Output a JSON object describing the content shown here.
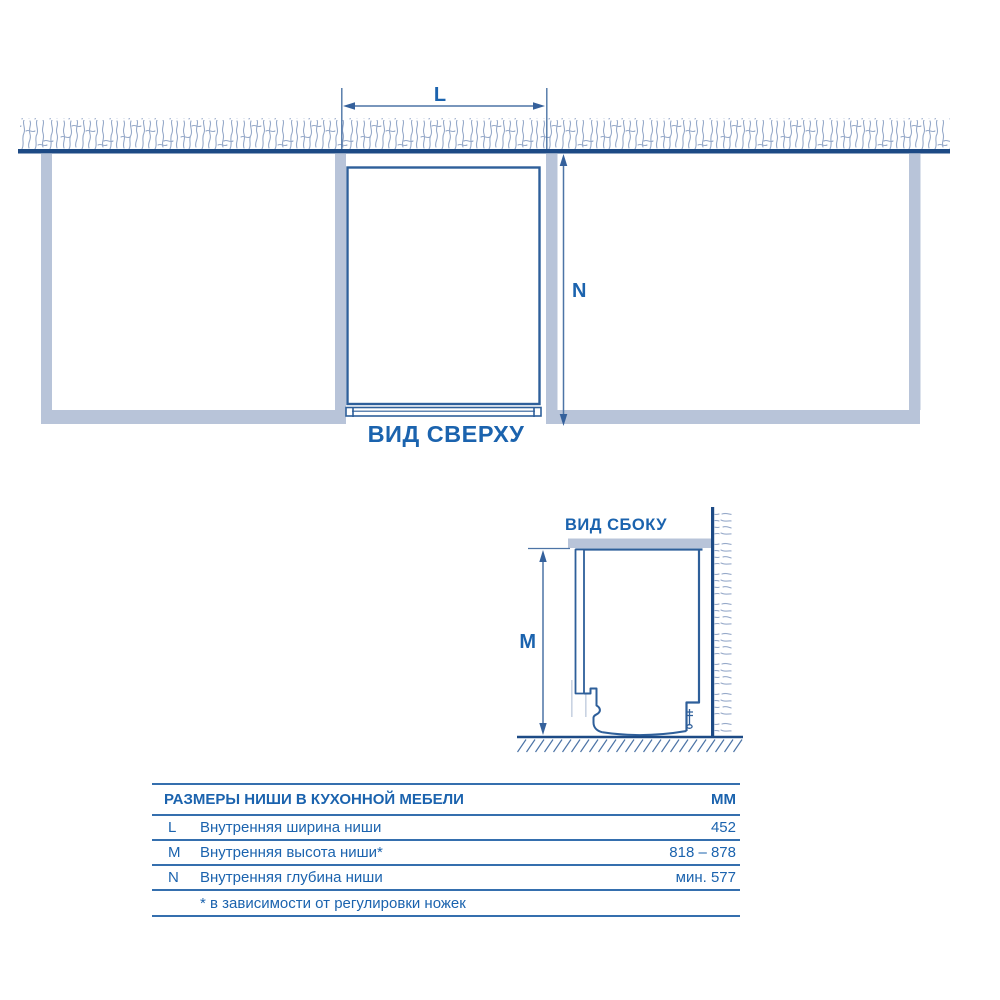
{
  "top_view": {
    "title": "ВИД СВЕРХУ",
    "width_dim_label": "L",
    "depth_dim_label": "N"
  },
  "side_view": {
    "title": "ВИД СБОКУ",
    "height_dim_label": "M"
  },
  "table": {
    "title": "РАЗМЕРЫ НИШИ В КУХОННОЙ МЕБЕЛИ",
    "unit_header": "ММ",
    "rows": [
      {
        "key": "L",
        "description": "Внутренняя ширина ниши",
        "value": "452"
      },
      {
        "key": "M",
        "description": "Внутренняя высота ниши*",
        "value": "818 – 878"
      },
      {
        "key": "N",
        "description": "Внутренняя глубина ниши",
        "value": "мин. 577"
      }
    ],
    "footnote": "* в зависимости от регулировки ножек"
  },
  "colors": {
    "wall_line": "#1d4a85",
    "outline": "#2e5f9a",
    "dimension": "#4d74a6",
    "counter_fill": "#b8c4d9",
    "hatch": "#96a9c9",
    "text": "#1b63ae",
    "table_rule": "#356fae"
  }
}
